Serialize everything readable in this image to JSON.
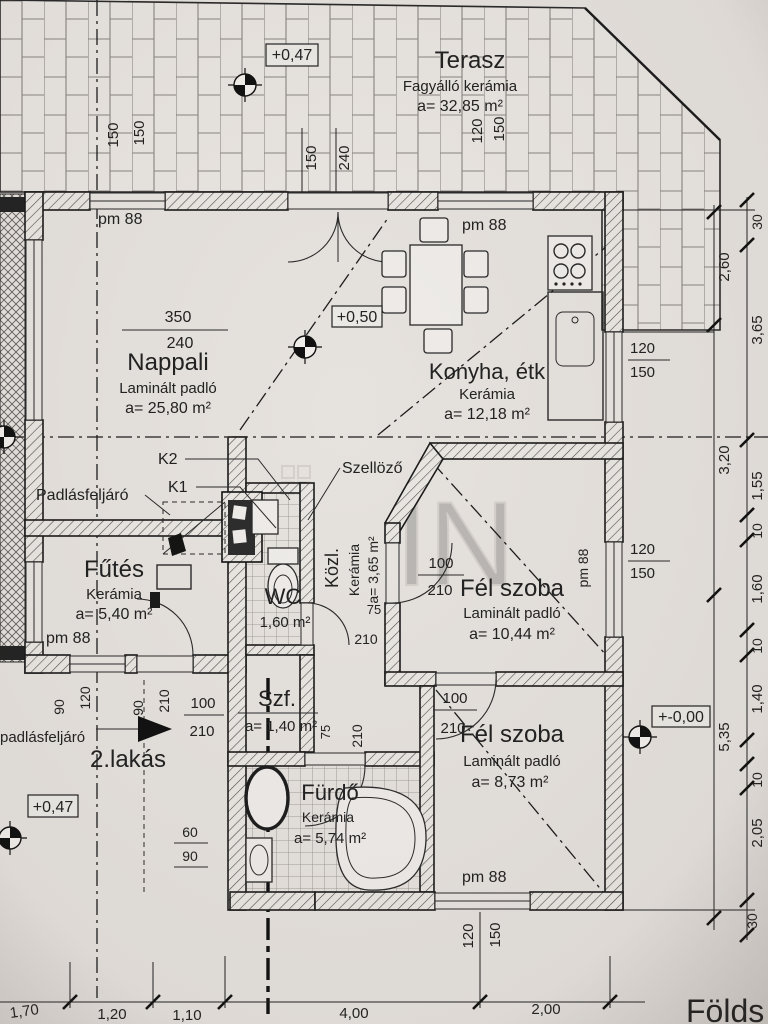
{
  "page": {
    "background": "#e6e2de",
    "ink": "#222222",
    "floor_label": "Földs"
  },
  "rooms": {
    "terasz": {
      "name": "Terasz",
      "finish": "Fagyálló kerámia",
      "area": "a= 32,85 m²"
    },
    "nappali": {
      "name": "Nappali",
      "finish": "Laminált padló",
      "area": "a= 25,80 m²"
    },
    "konyha": {
      "name": "Konyha, étk",
      "finish": "Kerámia",
      "area": "a= 12,18 m²"
    },
    "futes": {
      "name": "Fűtés",
      "finish": "Kerámia",
      "area": "a= 5,40 m²"
    },
    "wc": {
      "name": "WC",
      "area": "1,60 m²"
    },
    "kozl": {
      "name": "Közl.",
      "finish": "Kerámia",
      "area": "a= 3,65 m²"
    },
    "felszoba1": {
      "name": "Fél szoba",
      "finish": "Laminált padló",
      "area": "a= 10,44 m²"
    },
    "szf": {
      "name": "Szf.",
      "area": "a= 1,40 m²"
    },
    "felszoba2": {
      "name": "Fél szoba",
      "finish": "Laminált padló",
      "area": "a= 8,73 m²"
    },
    "furdo": {
      "name": "Fürdő",
      "finish": "Kerámia",
      "area": "a= 5,74 m²"
    },
    "lakas2": {
      "name": "2.lakás"
    }
  },
  "labels": {
    "padlasfeljaro_upper": "Padlásfeljáró",
    "padlasfeljaro_lower": "padlásfeljáró",
    "szellozo": "Szellöző",
    "k1": "K1",
    "k2": "K2",
    "pm88": "pm 88",
    "watermark": "IN"
  },
  "levels": {
    "terrace": "+0,47",
    "apartment2": "+0,47",
    "kitchen": "+0,50",
    "ground": "+-0,00"
  },
  "dims": {
    "d10": "10",
    "d30": "30",
    "d60": "60",
    "d75": "75",
    "d90": "90",
    "d100": "100",
    "d120": "120",
    "d150": "150",
    "d210": "210",
    "d240": "240",
    "d350": "350",
    "m110": "1,10",
    "m120": "1,20",
    "m140": "1,40",
    "m155": "1,55",
    "m160": "1,60",
    "m170": "1,70",
    "m200": "2,00",
    "m205": "2,05",
    "m260": "2,60",
    "m320": "3,20",
    "m365": "3,65",
    "m400": "4,00",
    "m535": "5,35"
  }
}
